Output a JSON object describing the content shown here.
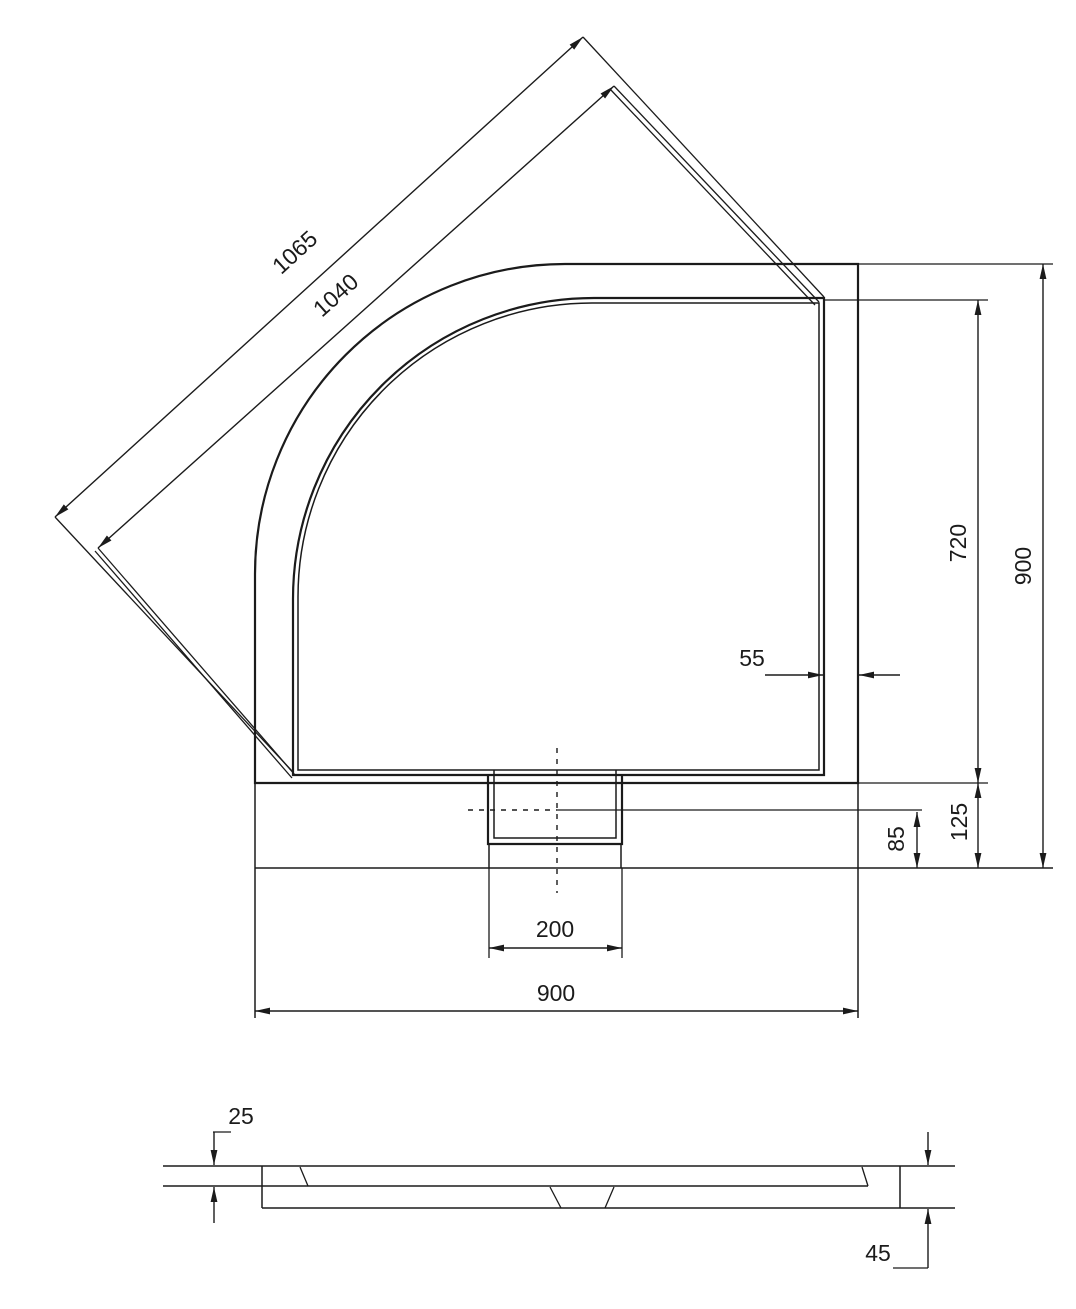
{
  "drawing": {
    "type": "technical-dimension-drawing",
    "subject": "quadrant shower tray",
    "background_color": "#ffffff",
    "line_color": "#1b1b1b",
    "views": {
      "plan": {
        "name": "top view",
        "dims": {
          "diag_outer": "1065",
          "diag_inner": "1040",
          "rim_width": "55",
          "inner_depth": "720",
          "overall_depth": "900",
          "apron_depth": "125",
          "drain_center_offset": "85",
          "drain_width": "200",
          "overall_width": "900"
        }
      },
      "side": {
        "name": "side section view",
        "dims": {
          "rim_height": "25",
          "total_height": "45"
        }
      }
    }
  }
}
